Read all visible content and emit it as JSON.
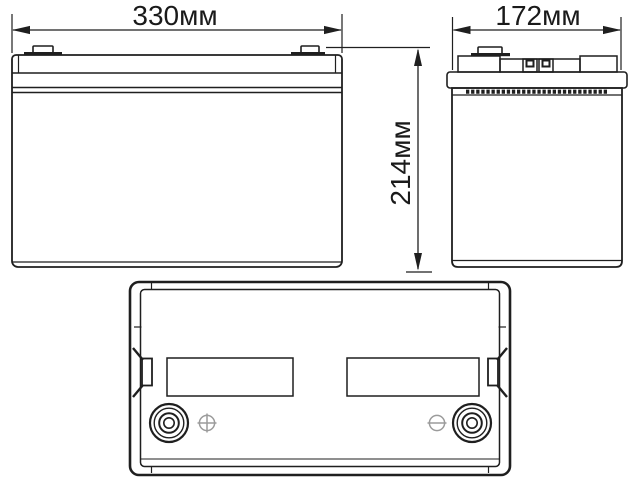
{
  "drawing": {
    "kind": "battery technical dimension drawing",
    "background_color": "#ffffff",
    "line_color": "#1f1f1f",
    "polarity_symbol_color": "#9b9b9b",
    "dimensions": {
      "width": "330мм",
      "depth": "172мм",
      "height": "214мм"
    },
    "icons": {
      "positive": "circle-plus",
      "negative": "circle-minus"
    }
  }
}
